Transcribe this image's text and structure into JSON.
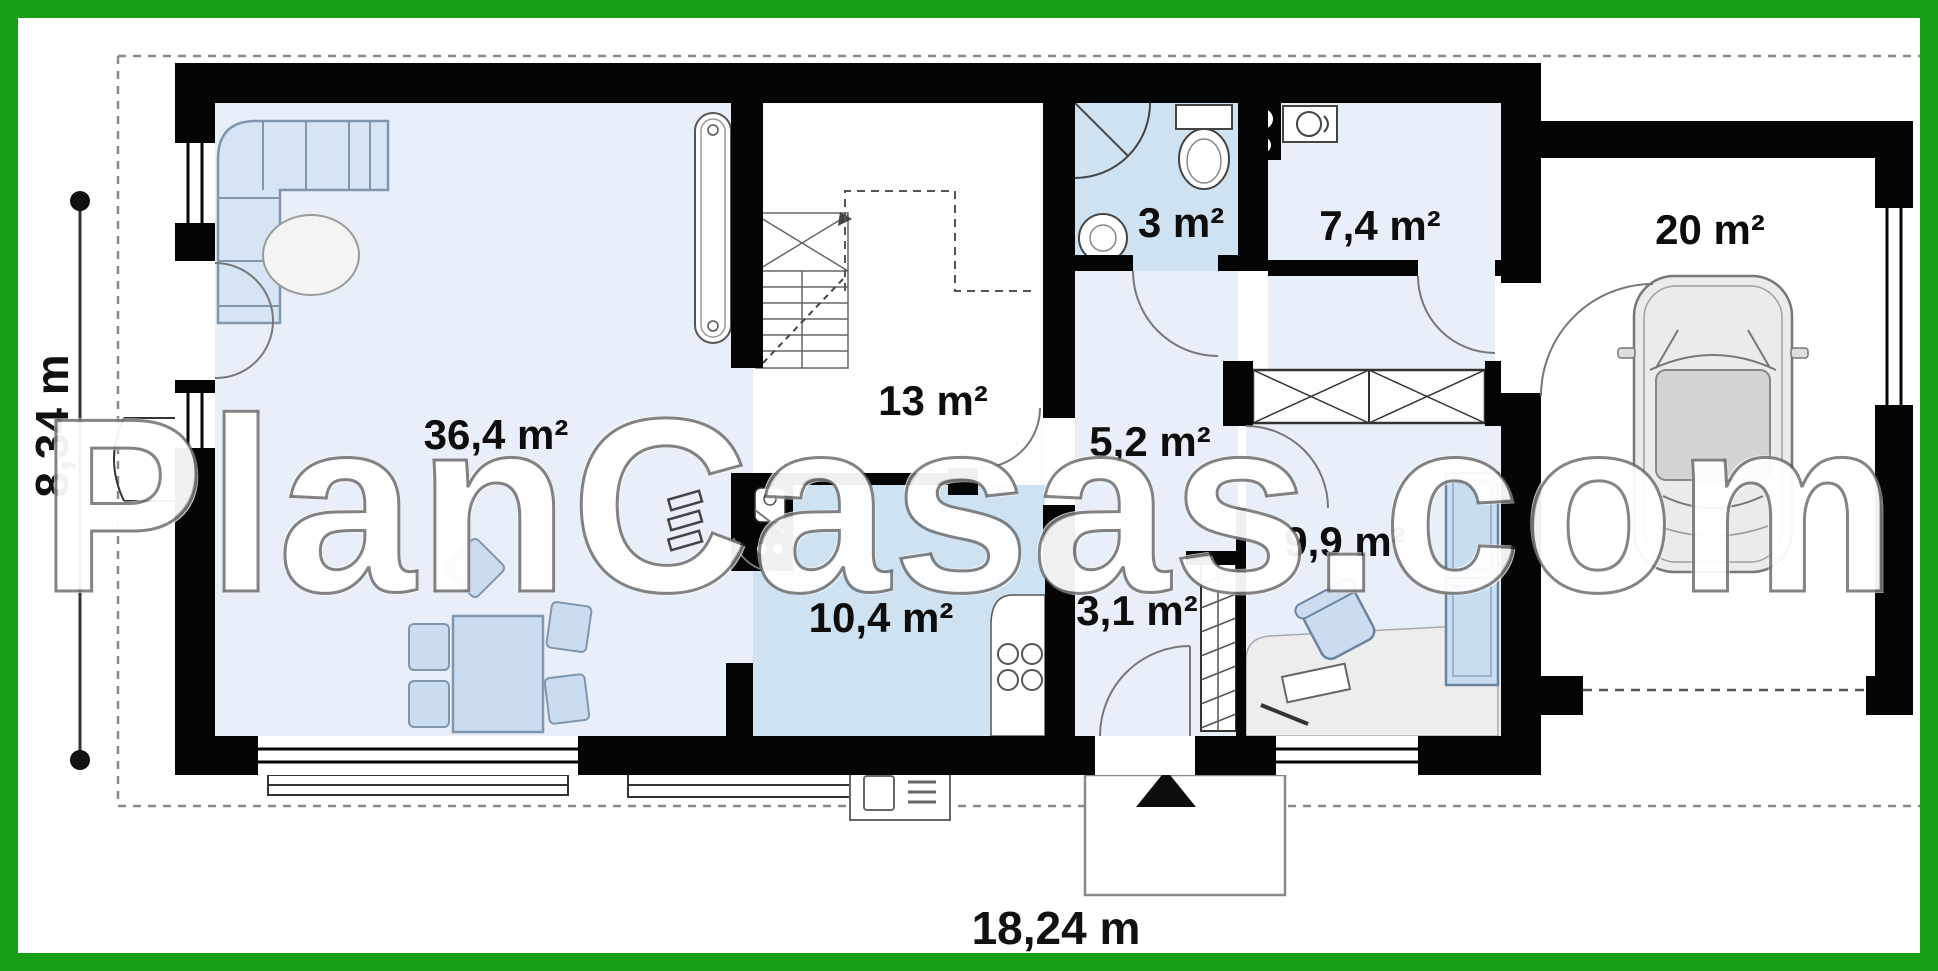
{
  "watermark_text": "PlanCasas.com",
  "dimensions": {
    "width_label": "18,24 m",
    "height_label": "8,34 m"
  },
  "rooms": {
    "living": "36,4 m²",
    "hall": "13 m²",
    "bathroom": "3 m²",
    "utility": "7,4 m²",
    "garage": "20 m²",
    "corridor": "5,2 m²",
    "office": "9,9 m²",
    "kitchen": "10,4 m²",
    "entry": "3,1 m²"
  },
  "colors": {
    "border_green": "#17a017",
    "wall_black": "#050505",
    "floor_light_blue": "#e9eff8",
    "floor_medium_blue": "#cfe2f2",
    "furniture_blue": "#ccdcf0"
  }
}
